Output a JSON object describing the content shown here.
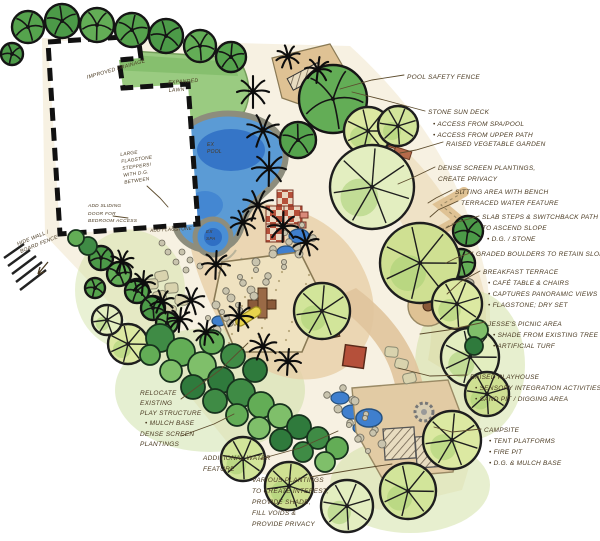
{
  "title": "Residential Landscape Design Concept Plan",
  "colors": {
    "paper": "#ffffff",
    "ink": "#4a3a22",
    "leader": "#5d4c2e",
    "lawn": "#96ca7c",
    "water": "#4a8fd6",
    "water_deep": "#2f6fc4",
    "canopy_light": "#d9e8a0",
    "canopy_dark": "#55a34d",
    "shrub_green": "#3f8b45",
    "patio_tan": "#e5cda6",
    "sand": "#efe2c0",
    "brick_red": "#b5503a",
    "stone_gray": "#c9c4ae",
    "deck_tan": "#dfc294"
  },
  "annotations": [
    {
      "name": "pool-safety-fence",
      "lines": [
        "POOL SAFETY FENCE"
      ]
    },
    {
      "name": "stone-sun-deck",
      "lines": [
        "STONE SUN DECK",
        "• ACCESS FROM SPA/POOL",
        "• ACCESS FROM UPPER PATH"
      ]
    },
    {
      "name": "raised-vegetable-garden",
      "lines": [
        "RAISED VEGETABLE GARDEN"
      ]
    },
    {
      "name": "dense-screen-privacy",
      "lines": [
        "DENSE SCREEN PLANTINGS,",
        "CREATE PRIVACY"
      ]
    },
    {
      "name": "sitting-area-bench",
      "lines": [
        "SITTING AREA WITH BENCH"
      ]
    },
    {
      "name": "terraced-water-feature",
      "lines": [
        "TERRACED WATER FEATURE"
      ]
    },
    {
      "name": "slab-steps-switchback",
      "lines": [
        "SLAB STEPS & SWITCHBACK PATH",
        "TO ASCEND SLOPE",
        "• D.G. / STONE"
      ]
    },
    {
      "name": "graded-boulders",
      "lines": [
        "GRADED BOULDERS TO RETAIN SLOPE"
      ]
    },
    {
      "name": "breakfast-terrace",
      "lines": [
        "BREAKFAST TERRACE",
        "• CAFÉ TABLE & CHAIRS",
        "• CAPTURES PANORAMIC VIEWS",
        "• FLAGSTONE; DRY SET"
      ]
    },
    {
      "name": "jesses-picnic-area",
      "lines": [
        "JESSE'S PICNIC AREA",
        "• SHADE FROM EXISTING TREE",
        "• ARTIFICIAL TURF"
      ]
    },
    {
      "name": "raised-playhouse",
      "lines": [
        "RAISED PLAYHOUSE",
        "• SENSORY INTEGRATION ACTIVITIES",
        "• SAND PIT / DIGGING AREA"
      ]
    },
    {
      "name": "campsite",
      "lines": [
        "CAMPSITE",
        "• TENT PLATFORMS",
        "• FIRE PIT",
        "• D.G. & MULCH BASE"
      ]
    },
    {
      "name": "relocate-play-structure",
      "lines": [
        "RELOCATE",
        "EXISTING",
        "PLAY STRUCTURE",
        "• MULCH BASE"
      ]
    },
    {
      "name": "dense-screen-plantings",
      "lines": [
        "DENSE SCREEN",
        "PLANTINGS"
      ]
    },
    {
      "name": "additional-water-feature",
      "lines": [
        "ADDITIONAL WATER",
        "FEATURE"
      ]
    },
    {
      "name": "various-plantings",
      "lines": [
        "VARIOUS PLANTINGS",
        "TO CREATE INTEREST,",
        "PROVIDE SHADE,",
        "FILL VOIDS &",
        "PROVIDE PRIVACY"
      ]
    },
    {
      "name": "flagstone-steppers",
      "lines": [
        "LARGE",
        "FLAGSTONE",
        "STEPPERS!",
        "WITH D.G.",
        "BETWEEN"
      ]
    },
    {
      "name": "sliding-door",
      "lines": [
        "ADD SLIDING",
        "DOOR FOR",
        "BEDROOM ACCESS"
      ]
    },
    {
      "name": "hide-wall-fence",
      "lines": [
        "HIDE WALL /",
        "BOARD FENCE"
      ]
    },
    {
      "name": "improved-drainage",
      "lines": [
        "IMPROVED DRAINAGE"
      ]
    },
    {
      "name": "expanded-lawn",
      "lines": [
        "EXPANDED",
        "LAWN"
      ]
    },
    {
      "name": "ex-pool",
      "lines": [
        "EX",
        "POOL"
      ]
    },
    {
      "name": "ex-spa",
      "lines": [
        "EX",
        "SPA"
      ]
    },
    {
      "name": "add-flagstone",
      "lines": [
        "ADD FLAGSTONE"
      ]
    }
  ]
}
